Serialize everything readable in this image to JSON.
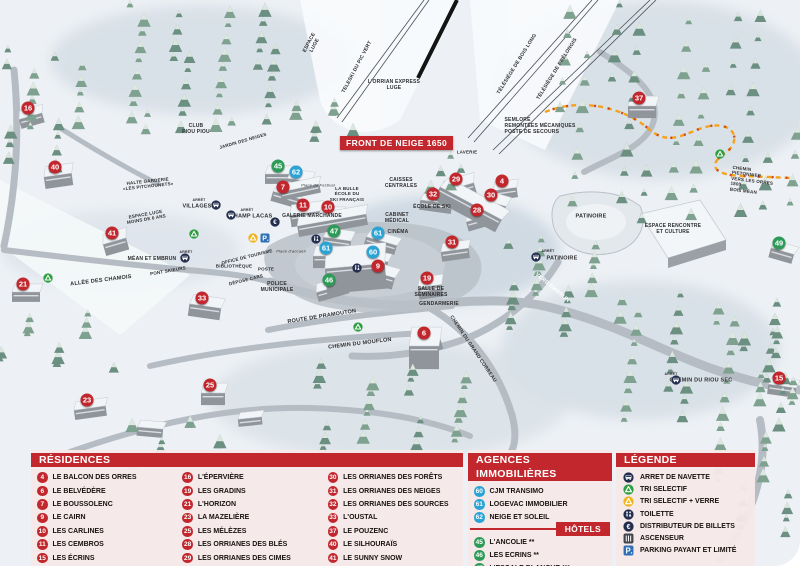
{
  "map": {
    "front_banner": "FRONT DE NEIGE 1650",
    "badges": [
      {
        "n": "16",
        "c": "red",
        "x": 28,
        "y": 108
      },
      {
        "n": "40",
        "c": "red",
        "x": 55,
        "y": 167
      },
      {
        "n": "45",
        "c": "green",
        "x": 278,
        "y": 166
      },
      {
        "n": "62",
        "c": "blue",
        "x": 296,
        "y": 172
      },
      {
        "n": "7",
        "c": "red",
        "x": 283,
        "y": 187
      },
      {
        "n": "29",
        "c": "red",
        "x": 456,
        "y": 179
      },
      {
        "n": "4",
        "c": "red",
        "x": 502,
        "y": 181
      },
      {
        "n": "37",
        "c": "red",
        "x": 639,
        "y": 98
      },
      {
        "n": "32",
        "c": "red",
        "x": 433,
        "y": 194
      },
      {
        "n": "30",
        "c": "red",
        "x": 491,
        "y": 195
      },
      {
        "n": "28",
        "c": "red",
        "x": 477,
        "y": 210
      },
      {
        "n": "11",
        "c": "red",
        "x": 303,
        "y": 205
      },
      {
        "n": "10",
        "c": "red",
        "x": 328,
        "y": 207
      },
      {
        "n": "47",
        "c": "green",
        "x": 334,
        "y": 231
      },
      {
        "n": "61",
        "c": "blue",
        "x": 378,
        "y": 233
      },
      {
        "n": "41",
        "c": "red",
        "x": 112,
        "y": 233
      },
      {
        "n": "31",
        "c": "red",
        "x": 452,
        "y": 242
      },
      {
        "n": "61",
        "c": "blue",
        "x": 326,
        "y": 248
      },
      {
        "n": "60",
        "c": "blue",
        "x": 373,
        "y": 252
      },
      {
        "n": "9",
        "c": "red",
        "x": 378,
        "y": 266
      },
      {
        "n": "46",
        "c": "green",
        "x": 329,
        "y": 280
      },
      {
        "n": "19",
        "c": "red",
        "x": 427,
        "y": 278
      },
      {
        "n": "21",
        "c": "red",
        "x": 23,
        "y": 284
      },
      {
        "n": "33",
        "c": "red",
        "x": 202,
        "y": 298
      },
      {
        "n": "49",
        "c": "green",
        "x": 779,
        "y": 243
      },
      {
        "n": "6",
        "c": "red",
        "x": 424,
        "y": 333
      },
      {
        "n": "23",
        "c": "red",
        "x": 87,
        "y": 400
      },
      {
        "n": "25",
        "c": "red",
        "x": 210,
        "y": 385
      },
      {
        "n": "15",
        "c": "red",
        "x": 779,
        "y": 378
      }
    ],
    "labels": [
      {
        "t": "CLUB\nPIOU PIOU",
        "x": 196,
        "y": 129,
        "s": 5
      },
      {
        "t": "JARDIN DES NEIGES",
        "x": 243,
        "y": 141,
        "s": 4.5,
        "r": -16
      },
      {
        "t": "HALTE GARDERIE\n«LES PITCHOUNETS»",
        "x": 148,
        "y": 184,
        "s": 4.5,
        "r": -6
      },
      {
        "t": "ESPACE\nLUGE",
        "x": 312,
        "y": 44,
        "s": 5,
        "r": -62
      },
      {
        "t": "TELESKI DU PIC VERT",
        "x": 357,
        "y": 67,
        "s": 5,
        "r": -62
      },
      {
        "t": "L'ORRIAN EXPRESS\nLUGE",
        "x": 394,
        "y": 85,
        "s": 5
      },
      {
        "t": "TÉLÉSIÈGE DE BOIS LONG",
        "x": 517,
        "y": 64,
        "s": 5,
        "r": -58
      },
      {
        "t": "TÉLÉSIÈGE DE PRÉLONGIS",
        "x": 557,
        "y": 69,
        "s": 5,
        "r": -58
      },
      {
        "t": "SEMLORE\nREMONTÉES MÉCANIQUES\nPOSTE DE SECOURS",
        "x": 540,
        "y": 126,
        "s": 5,
        "al": "left"
      },
      {
        "t": "LAVERIE",
        "x": 467,
        "y": 152,
        "s": 4.5
      },
      {
        "t": "CAISSES\nCENTRALES",
        "x": 401,
        "y": 183,
        "s": 5
      },
      {
        "t": "Place du Festival",
        "x": 318,
        "y": 186,
        "s": 4,
        "it": 1,
        "fw": 1
      },
      {
        "t": "LA BULLE\nÉCOLE DU\nSKI FRANÇAIS",
        "x": 347,
        "y": 194,
        "s": 4.5
      },
      {
        "t": "ARRÊT",
        "x": 199,
        "y": 200,
        "s": 3.5
      },
      {
        "t": "VILLAGES",
        "x": 197,
        "y": 207,
        "s": 5.5
      },
      {
        "t": "ARRÊT",
        "x": 247,
        "y": 210,
        "s": 3.5
      },
      {
        "t": "CHAMP LACAS",
        "x": 251,
        "y": 217,
        "s": 5.5
      },
      {
        "t": "ESPACE LUGE\nMOINS DE 6 ANS",
        "x": 146,
        "y": 217,
        "s": 4.5,
        "r": -10
      },
      {
        "t": "GALERIE MARCHANDE",
        "x": 312,
        "y": 216,
        "s": 5
      },
      {
        "t": "CABINET\nMÉDICAL",
        "x": 397,
        "y": 218,
        "s": 5
      },
      {
        "t": "ÉCOLE DE SKI",
        "x": 432,
        "y": 207,
        "s": 5
      },
      {
        "t": "CINÉMA",
        "x": 398,
        "y": 232,
        "s": 5
      },
      {
        "t": "OFFICE DE TOURISME",
        "x": 247,
        "y": 257,
        "s": 4.5,
        "r": -14
      },
      {
        "t": "BIBLIOTHÈQUE",
        "x": 234,
        "y": 266,
        "s": 4.5
      },
      {
        "t": "POSTE",
        "x": 266,
        "y": 269,
        "s": 4.5
      },
      {
        "t": "DÉPOSE CARS",
        "x": 246,
        "y": 280,
        "s": 4.5,
        "r": -14
      },
      {
        "t": "POLICE\nMUNICIPALE",
        "x": 277,
        "y": 287,
        "s": 5
      },
      {
        "t": "Place d'accueil",
        "x": 291,
        "y": 252,
        "s": 4,
        "it": 1,
        "fw": 1
      },
      {
        "t": "ARRÊT",
        "x": 186,
        "y": 252,
        "s": 3.5
      },
      {
        "t": "MÉAN ET EMBRUN",
        "x": 152,
        "y": 259,
        "s": 5
      },
      {
        "t": "PONT SKIEURS",
        "x": 168,
        "y": 271,
        "s": 4.5,
        "r": -10
      },
      {
        "t": "ALLÉE DES CHAMOIS",
        "x": 101,
        "y": 281,
        "s": 5.5,
        "r": -7
      },
      {
        "t": "PATINOIRE",
        "x": 591,
        "y": 217,
        "s": 5.5
      },
      {
        "t": "ARRÊT",
        "x": 548,
        "y": 251,
        "s": 3.5
      },
      {
        "t": "PATINOIRE",
        "x": 562,
        "y": 259,
        "s": 5.5
      },
      {
        "t": "VERS EMBRUN",
        "x": 552,
        "y": 288,
        "s": 5.5,
        "r": 40,
        "col": "#ffffff"
      },
      {
        "t": "ESPACE RENCONTRE\nET CULTURE",
        "x": 673,
        "y": 229,
        "s": 5
      },
      {
        "t": "SALLE DE\nSÉMINAIRES",
        "x": 431,
        "y": 292,
        "s": 5
      },
      {
        "t": "GENDARMERIE",
        "x": 439,
        "y": 304,
        "s": 5
      },
      {
        "t": "ROUTE DE PRAMOUTON",
        "x": 322,
        "y": 317,
        "s": 5.5,
        "r": -9
      },
      {
        "t": "CHEMIN DU MOUFLON",
        "x": 360,
        "y": 344,
        "s": 5.5,
        "r": -7
      },
      {
        "t": "CHEMIN DU GRAND CORBEAU",
        "x": 473,
        "y": 349,
        "s": 5,
        "r": 56
      },
      {
        "t": "CHEMIN PIETONNIER\nVERS LES ORRES 1800\nBOIS MÉAN",
        "x": 754,
        "y": 181,
        "s": 4.5,
        "r": 7,
        "al": "left"
      },
      {
        "t": "ARRÊT",
        "x": 671,
        "y": 374,
        "s": 3.5
      },
      {
        "t": "CHEMIN DU RIOU SEC",
        "x": 701,
        "y": 381,
        "s": 5.5
      }
    ],
    "icons": [
      {
        "k": "bus",
        "x": 216,
        "y": 205
      },
      {
        "k": "bus",
        "x": 231,
        "y": 215
      },
      {
        "k": "bus",
        "x": 185,
        "y": 258
      },
      {
        "k": "bus",
        "x": 536,
        "y": 257
      },
      {
        "k": "bus",
        "x": 676,
        "y": 380
      },
      {
        "k": "recycle-green",
        "x": 194,
        "y": 234
      },
      {
        "k": "recycle-green",
        "x": 48,
        "y": 278
      },
      {
        "k": "recycle-green",
        "x": 358,
        "y": 327
      },
      {
        "k": "recycle-green",
        "x": 720,
        "y": 154
      },
      {
        "k": "recycle-yellow",
        "x": 253,
        "y": 238
      },
      {
        "k": "parking",
        "x": 265,
        "y": 238
      },
      {
        "k": "wc",
        "x": 316,
        "y": 239
      },
      {
        "k": "wc",
        "x": 357,
        "y": 268
      },
      {
        "k": "euro",
        "x": 275,
        "y": 222
      }
    ]
  },
  "legend": {
    "residences": {
      "title": "RÉSIDENCES",
      "items": [
        {
          "n": "4",
          "c": "red",
          "name": "LE BALCON DES ORRES"
        },
        {
          "n": "6",
          "c": "red",
          "name": "LE BELVÉDÈRE"
        },
        {
          "n": "7",
          "c": "red",
          "name": "LE BOUSSOLENC"
        },
        {
          "n": "9",
          "c": "red",
          "name": "LE CAIRN"
        },
        {
          "n": "10",
          "c": "red",
          "name": "LES CARLINES"
        },
        {
          "n": "11",
          "c": "red",
          "name": "LES CEMBROS"
        },
        {
          "n": "15",
          "c": "red",
          "name": "LES ÉCRINS"
        },
        {
          "n": "16",
          "c": "red",
          "name": "L'ÉPERVIÈRE"
        },
        {
          "n": "19",
          "c": "red",
          "name": "LES GRADINS"
        },
        {
          "n": "21",
          "c": "red",
          "name": "L'HORIZON"
        },
        {
          "n": "23",
          "c": "red",
          "name": "LA MAZELIÈRE"
        },
        {
          "n": "25",
          "c": "red",
          "name": "LES MÉLÈZES"
        },
        {
          "n": "28",
          "c": "red",
          "name": "LES ORRIANES DES BLÉS"
        },
        {
          "n": "29",
          "c": "red",
          "name": "LES ORRIANES DES CIMES"
        },
        {
          "n": "30",
          "c": "red",
          "name": "LES ORRIANES DES FORÊTS"
        },
        {
          "n": "31",
          "c": "red",
          "name": "LES ORRIANES DES NEIGES"
        },
        {
          "n": "32",
          "c": "red",
          "name": "LES ORRIANES DES SOURCES"
        },
        {
          "n": "33",
          "c": "red",
          "name": "L'OUSTAL"
        },
        {
          "n": "37",
          "c": "red",
          "name": "LE POUZENC"
        },
        {
          "n": "40",
          "c": "red",
          "name": "LE SILHOURAÏS"
        },
        {
          "n": "41",
          "c": "red",
          "name": "LE SUNNY SNOW"
        }
      ]
    },
    "agences": {
      "title": "AGENCES IMMOBILIÈRES",
      "items": [
        {
          "n": "60",
          "c": "blue",
          "name": "CJM TRANSIMO"
        },
        {
          "n": "61",
          "c": "blue",
          "name": "LOGEVAC IMMOBILIER"
        },
        {
          "n": "62",
          "c": "blue",
          "name": "NEIGE ET SOLEIL"
        }
      ]
    },
    "hotels": {
      "title": "HÔTELS",
      "items": [
        {
          "n": "45",
          "c": "green",
          "name": "L'ANCOLIE **"
        },
        {
          "n": "46",
          "c": "green",
          "name": "LES ECRINS **"
        },
        {
          "n": "47",
          "c": "green",
          "name": "L'ESCALE BLANCHE ***"
        },
        {
          "n": "49",
          "c": "green",
          "name": "LES TRAPPEURS **"
        }
      ]
    },
    "legende": {
      "title": "LÉGENDE",
      "items": [
        {
          "icon": "bus-icon",
          "label": "ARRET DE NAVETTE"
        },
        {
          "icon": "recycle-green-icon",
          "label": "TRI SELECTIF"
        },
        {
          "icon": "recycle-yellow-icon",
          "label": "TRI SELECTIF + VERRE"
        },
        {
          "icon": "wc-icon",
          "label": "TOILETTE"
        },
        {
          "icon": "euro-icon",
          "label": "DISTRIBUTEUR DE BILLETS"
        },
        {
          "icon": "elevator-icon",
          "label": "ASCENSEUR"
        },
        {
          "icon": "parking-icon",
          "label": "PARKING PAYANT ET LIMITÉ"
        }
      ]
    }
  },
  "colors": {
    "accent_red": "#c1272d",
    "hotel_green": "#2d9b57",
    "agency_blue": "#2ba3d4",
    "parking_blue": "#2f6fb6",
    "path_orange": "#f5a21b"
  }
}
